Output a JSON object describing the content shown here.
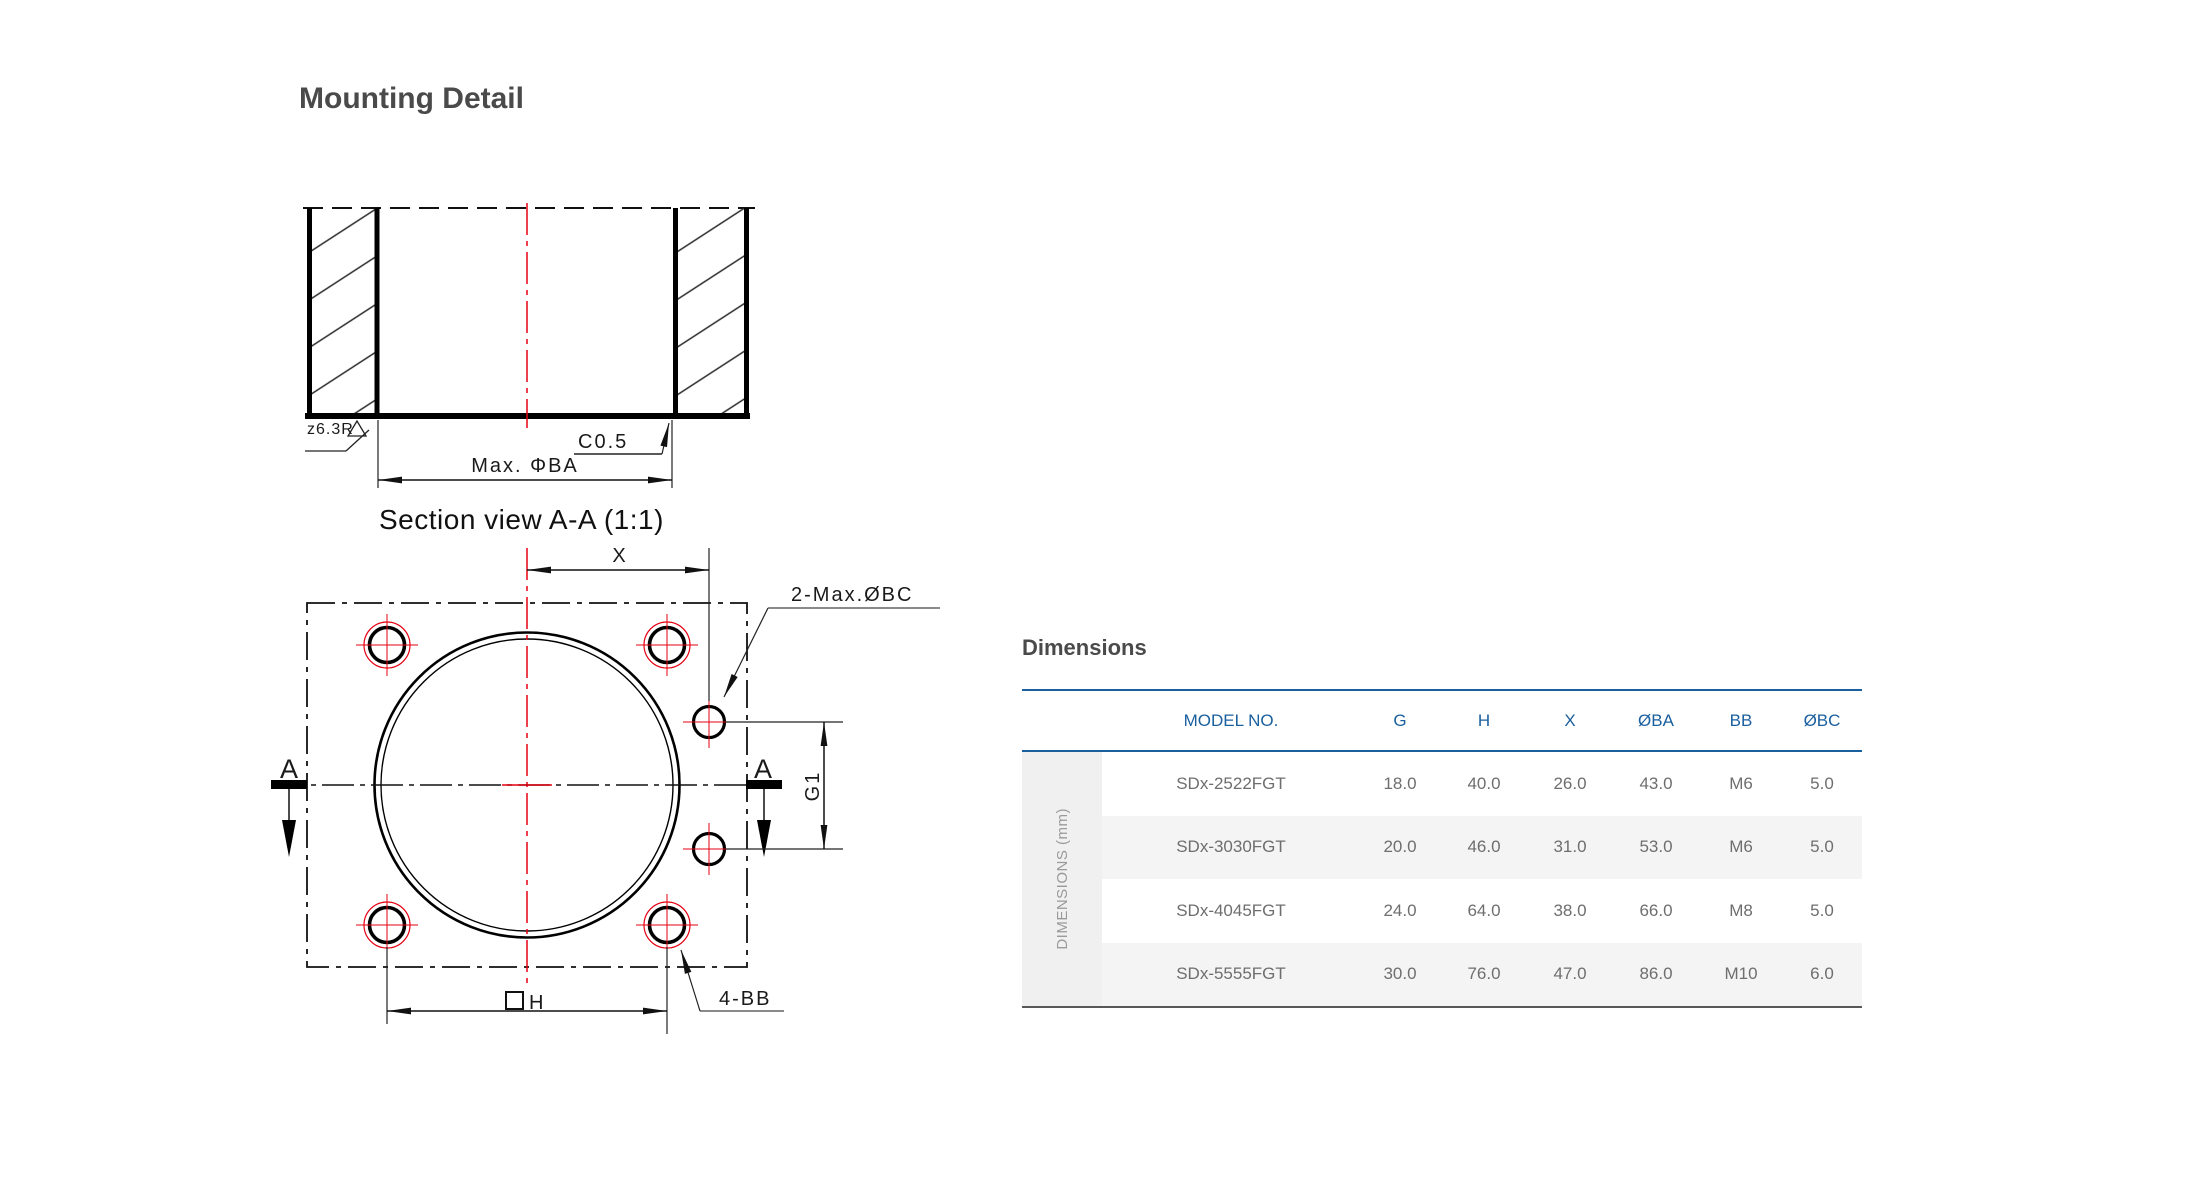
{
  "page": {
    "title": "Mounting Detail"
  },
  "colors": {
    "accent_blue": "#1a5f9e",
    "centerline_red": "#e60012",
    "heading_gray": "#4a4a4a",
    "table_text_gray": "#6e6e6e",
    "row_stripe": "#f4f4f4",
    "sidebar_bg": "#f0f0f0"
  },
  "drawing": {
    "section_view": {
      "caption": "Section view A-A (1:1)",
      "surface_finish_label": "z6.3R",
      "chamfer_label": "C0.5",
      "max_bore_label": "Max. ΦBA"
    },
    "plan_view": {
      "x_dim_label": "X",
      "bc_holes_label": "2-Max.ØBC",
      "section_marker_left": "A",
      "section_marker_right": "A",
      "g1_dim_label": "G1",
      "square_h_label": "H",
      "bb_holes_label": "4-BB"
    }
  },
  "dimensions": {
    "heading": "Dimensions",
    "table": {
      "side_label": "DIMENSIONS (mm)",
      "columns": [
        "MODEL NO.",
        "G",
        "H",
        "X",
        "ØBA",
        "BB",
        "ØBC"
      ],
      "rows": [
        {
          "model": "SDx-2522FGT",
          "g": "18.0",
          "h": "40.0",
          "x": "26.0",
          "oba": "43.0",
          "bb": "M6",
          "obc": "5.0"
        },
        {
          "model": "SDx-3030FGT",
          "g": "20.0",
          "h": "46.0",
          "x": "31.0",
          "oba": "53.0",
          "bb": "M6",
          "obc": "5.0"
        },
        {
          "model": "SDx-4045FGT",
          "g": "24.0",
          "h": "64.0",
          "x": "38.0",
          "oba": "66.0",
          "bb": "M8",
          "obc": "5.0"
        },
        {
          "model": "SDx-5555FGT",
          "g": "30.0",
          "h": "76.0",
          "x": "47.0",
          "oba": "86.0",
          "bb": "M10",
          "obc": "6.0"
        }
      ]
    }
  }
}
